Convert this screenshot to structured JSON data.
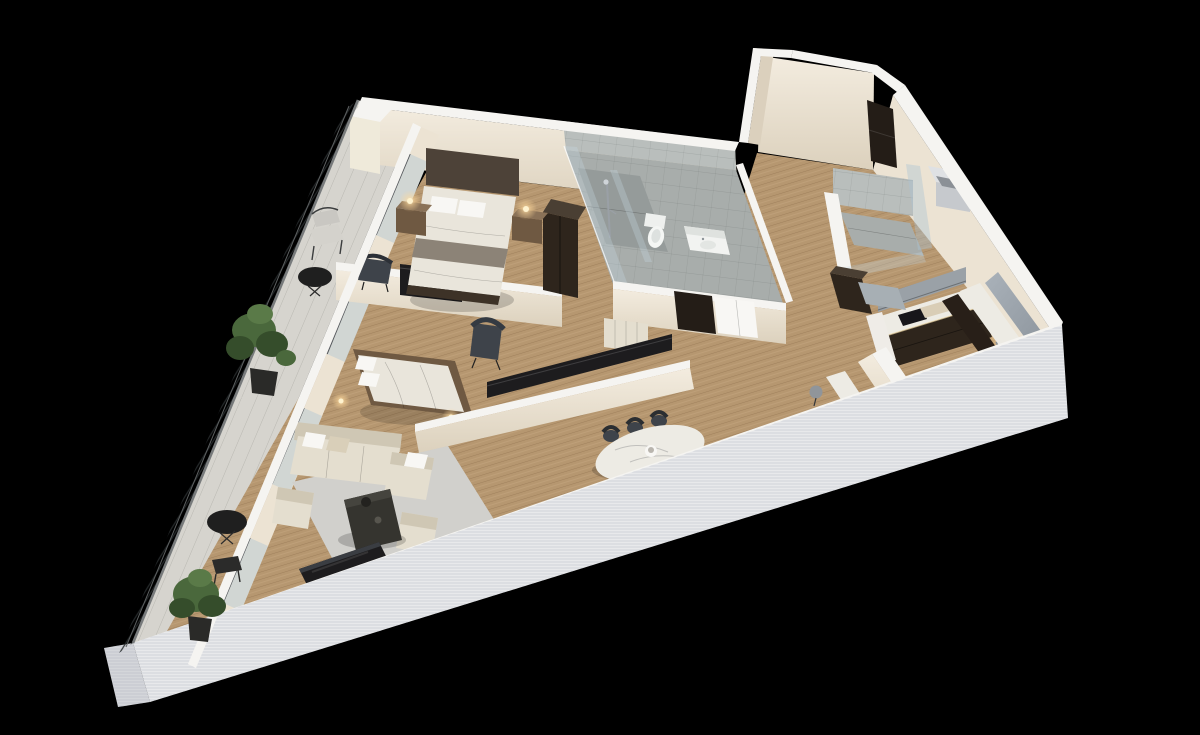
{
  "scene": {
    "title": "Isometric 3D apartment floor plan render on black background",
    "view": "axonometric top-down",
    "rooms": [
      {
        "id": "master-bedroom",
        "furniture": [
          "double-bed",
          "headboard-panel",
          "nightstand-left",
          "nightstand-right",
          "table-lamp-left",
          "table-lamp-right",
          "wardrobe",
          "accent-chair"
        ]
      },
      {
        "id": "master-bathroom",
        "furniture": [
          "walk-in-shower",
          "shower-column",
          "glass-partition",
          "toilet",
          "vanity-sink",
          "glass-front"
        ]
      },
      {
        "id": "entry-hall",
        "furniture": [
          "entry-door",
          "duct-shaft"
        ]
      },
      {
        "id": "second-bathroom",
        "furniture": [
          "shower-tray",
          "glass-panels"
        ]
      },
      {
        "id": "kitchen",
        "furniture": [
          "upper-cabinets",
          "backsplash-panel",
          "l-counter-marble",
          "base-cabinets",
          "cooktop",
          "cutting-board",
          "sink",
          "tall-cabinet",
          "side-counter",
          "bar-island",
          "bar-stools"
        ]
      },
      {
        "id": "dining-area",
        "furniture": [
          "marble-dining-table",
          "dining-chairs-6",
          "centerpiece-bowl"
        ]
      },
      {
        "id": "second-bedroom",
        "furniture": [
          "double-bed",
          "wing-chair",
          "wall-tv",
          "media-panel",
          "floor-lamps",
          "wardrobe-panel"
        ]
      },
      {
        "id": "living-room",
        "furniture": [
          "sectional-sofa",
          "armchair-left",
          "armchair-right",
          "coffee-table",
          "area-rug",
          "tv-unit"
        ]
      },
      {
        "id": "balcony",
        "furniture": [
          "metal-railing",
          "cafe-chair",
          "round-table-upper",
          "round-table-lower",
          "bench",
          "potted-plant-upper",
          "potted-plant-lower"
        ]
      }
    ]
  },
  "colors": {
    "background": "#000000",
    "wallTop": "#f5f4f1",
    "wallFace": "#ece3d3",
    "wallShade": "#dbd0bd",
    "wallOuter": "#e8e9eb",
    "wallOuterShade": "#d4d6da",
    "wood": "#b2926c",
    "stone": "#d6d4ce",
    "tile": "#a8adab",
    "tileWall": "#b9bebc",
    "tileDark": "#959b9a",
    "glass": "rgba(170,195,212,0.40)",
    "glassLite": "rgba(200,218,230,0.30)",
    "espresso": "#2e251c",
    "darkPanel": "#1d1c1e",
    "door": "#241d17",
    "charcoal": "#3e434a",
    "cream": "#e4decf",
    "creamShadow": "#cfc7b4",
    "duvet": "#e9e5db",
    "blanket": "#8c8377",
    "marble": "#edebe4",
    "metal": "#c3c7cb",
    "stool": "#90959a",
    "rug": "#cfcec9",
    "plant": "#4a683c",
    "plantDark": "#354d2b",
    "glow": "#ffd99b",
    "woodFurn": "#6f5942",
    "white": "#f8f7f4"
  }
}
